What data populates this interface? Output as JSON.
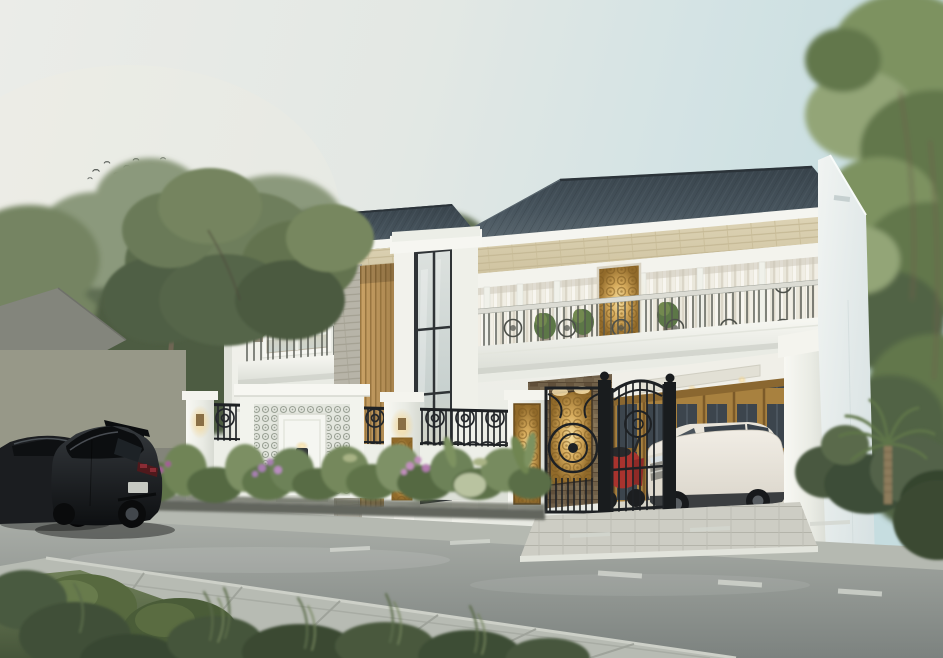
{
  "meta": {
    "domain": "Natural-Image",
    "description": "Photorealistic architectural exterior rendering of a two-story modern-classic luxury house at dusk, seen from across a two-lane street. Dark hip roof, white walls with limestone bands, balconies with ornate railings and sheer curtains, backlit gold-carved panels, ledgestone and timber-louver accents, a two-story glass tower window, a carport with a white SUV behind an ornate black wrought-iron gate, a red scooter, a white fence with iron lattice and lamp pillars, tropical flower beds, a black hatchback parked on the road, trees on both sides and a flock of birds in a pale sky."
  },
  "palette": {
    "sky-left": "#ebece8",
    "sky-right": "#c6dde0",
    "roof": "#47545d",
    "roof-dark": "#2d363d",
    "wall": "#f3f3ee",
    "fascia": "#f5f5f0",
    "soffit": "#f3f3ed",
    "cream-stone": "#d8cead",
    "ledgestone": "#b7b4a8",
    "louver-wood": "#c0995f",
    "feature-stone": "#6f5f48",
    "gold": "#d8ad5e",
    "iron": "#1e2124",
    "rail-bar": "#dcdcd4",
    "glass": "#ccd5d3",
    "curtain": "#eae7db",
    "neighbor-wall": "#979888",
    "road": "#9ba09d",
    "sidewalk": "#b5b9b1",
    "near-sidewalk": "#b7bbb3",
    "dash": "#d4d7d0",
    "grass": "#66774d",
    "foliage-dark": "#4d5b43",
    "foliage-mid": "#6d7d5b",
    "foliage-light": "#8b997b",
    "planter": "#62655d",
    "suv-body": "#ebe7de",
    "car-black": "#17191b",
    "scooter-red": "#a8332e",
    "bird": "#555a55",
    "floor": "#d6d4c8"
  },
  "scene": {
    "sky": {
      "tone_left": "#ebece8",
      "tone_right": "#c6dde0",
      "birds_count": 14
    },
    "house": {
      "stories": 2,
      "roof_color": "#47545d",
      "wall_color": "#f3f3ee",
      "features": [
        "hip roof with dark tiles",
        "limestone band under eaves",
        "balconies with ornate metal railing",
        "sheer white curtains",
        "backlit gold carved panels",
        "gray ledgestone cladding",
        "vertical timber louver screen",
        "two-story gridded glass tower window",
        "carport with timber-and-glass doors",
        "ornate black wrought-iron driveway gate",
        "white fence with iron lattice and lamp pillars",
        "tropical flower bed with purple and pink blooms"
      ]
    },
    "vehicles": [
      {
        "name": "black-hatchback",
        "color": "#17191b",
        "location": "street"
      },
      {
        "name": "dark-sedan",
        "color": "#1b1d20",
        "location": "street-left-edge"
      },
      {
        "name": "white-suv",
        "color": "#ebe7de",
        "location": "carport"
      },
      {
        "name": "red-scooter",
        "color": "#a8332e",
        "location": "behind-gate"
      }
    ],
    "street": {
      "lanes": 2,
      "markings": "white dashed center line",
      "sidewalks": "paved both sides"
    }
  }
}
